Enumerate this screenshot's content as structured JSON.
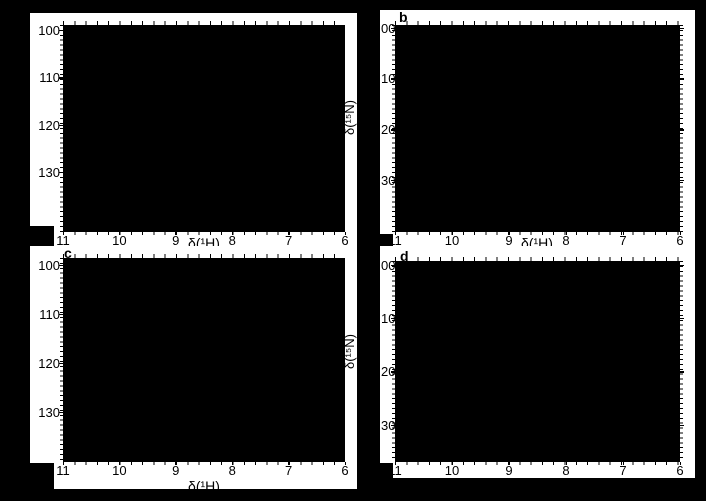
{
  "figure": {
    "background_color": "#000000",
    "panel_background_color": "#ffffff",
    "ink_color": "#000000"
  },
  "panels": [
    {
      "key": "a",
      "letter": "",
      "x_ticks": [
        "11",
        "10",
        "9",
        "8",
        "7",
        "6"
      ],
      "y_ticks": [
        "100",
        "110",
        "120",
        "130"
      ],
      "xlabel": "δ(¹H)",
      "ylabel": "δ(¹⁵N)",
      "clipped_y": false,
      "right_ticks": false
    },
    {
      "key": "b",
      "letter": "b",
      "x_ticks": [
        "11",
        "10",
        "9",
        "8",
        "7",
        "6"
      ],
      "y_ticks": [
        "00",
        "10",
        "20",
        "30"
      ],
      "xlabel": "δ(¹H)",
      "ylabel": "",
      "clipped_y": true,
      "right_ticks": true
    },
    {
      "key": "c",
      "letter": "c",
      "x_ticks": [
        "11",
        "10",
        "9",
        "8",
        "7",
        "6"
      ],
      "y_ticks": [
        "100",
        "110",
        "120",
        "130"
      ],
      "xlabel": "δ(¹H)",
      "ylabel": "δ(¹⁵N)",
      "clipped_y": false,
      "right_ticks": false
    },
    {
      "key": "d",
      "letter": "d",
      "x_ticks": [
        "11",
        "10",
        "9",
        "8",
        "7",
        "6"
      ],
      "y_ticks": [
        "00",
        "10",
        "20",
        "30"
      ],
      "xlabel": "",
      "ylabel": "",
      "clipped_y": true,
      "right_ticks": true
    }
  ],
  "chart_data": {
    "type": "heatmap",
    "title": "",
    "description": "Four-panel 2D ¹H–¹⁵N NMR correlation spectra (HSQC-style). Each plot interior renders as a solid black region; no individual cross-peaks are resolvable in the image.",
    "xlabel": "δ(¹H)",
    "ylabel": "δ(¹⁵N)",
    "x_tick_values": [
      11,
      10,
      9,
      8,
      7,
      6
    ],
    "y_tick_values": [
      100,
      110,
      120,
      130
    ],
    "grid": false,
    "legend": null,
    "values": "uniform black fill (no discernible data points)",
    "panels": [
      {
        "id": "a",
        "letter_visible": false,
        "xlim": [
          11,
          6
        ],
        "ylim": [
          98.7,
          142.5
        ]
      },
      {
        "id": "b",
        "letter_visible": true,
        "xlim": [
          11,
          6
        ],
        "ylim": [
          99.3,
          140.0
        ]
      },
      {
        "id": "c",
        "letter_visible": true,
        "xlim": [
          11,
          6
        ],
        "ylim": [
          98.4,
          140.0
        ]
      },
      {
        "id": "d",
        "letter_visible": true,
        "xlim": [
          11,
          6
        ],
        "ylim": [
          99.1,
          136.8
        ]
      }
    ]
  }
}
